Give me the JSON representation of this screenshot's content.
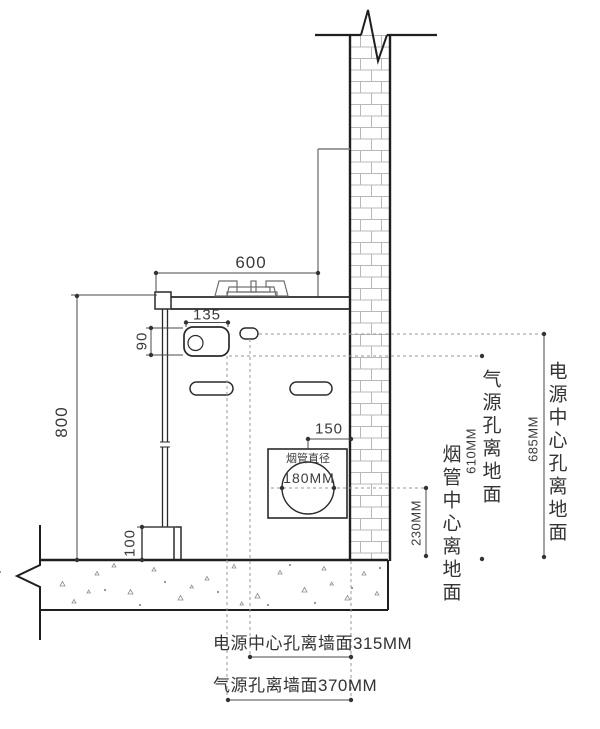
{
  "dimensions": {
    "counter_width": "600",
    "gas_box_width": "135",
    "gas_box_height": "90",
    "counter_height": "800",
    "toe_kick_height": "100",
    "flue_to_wall": "150"
  },
  "flue": {
    "label": "烟管直径",
    "diameter": "180MM"
  },
  "right_annotations": {
    "flue_center_to_floor": {
      "label": "烟管中心离地面",
      "value": "230MM"
    },
    "gas_hole_to_floor": {
      "label": "气源孔离地面",
      "value": "610MM"
    },
    "power_center_to_floor": {
      "label": "电源中心孔离地面",
      "value": "685MM"
    }
  },
  "bottom_annotations": {
    "power_center_to_wall": "电源中心孔离墙面315MM",
    "gas_hole_to_wall": "气源孔离墙面370MM"
  },
  "colors": {
    "line": "#2a2a2a",
    "dim_line": "#4a4a4a",
    "dashed": "#9a9a9a",
    "brick_mortar": "#b8b8b8",
    "panel": "#7d7d7d",
    "background": "#ffffff"
  }
}
